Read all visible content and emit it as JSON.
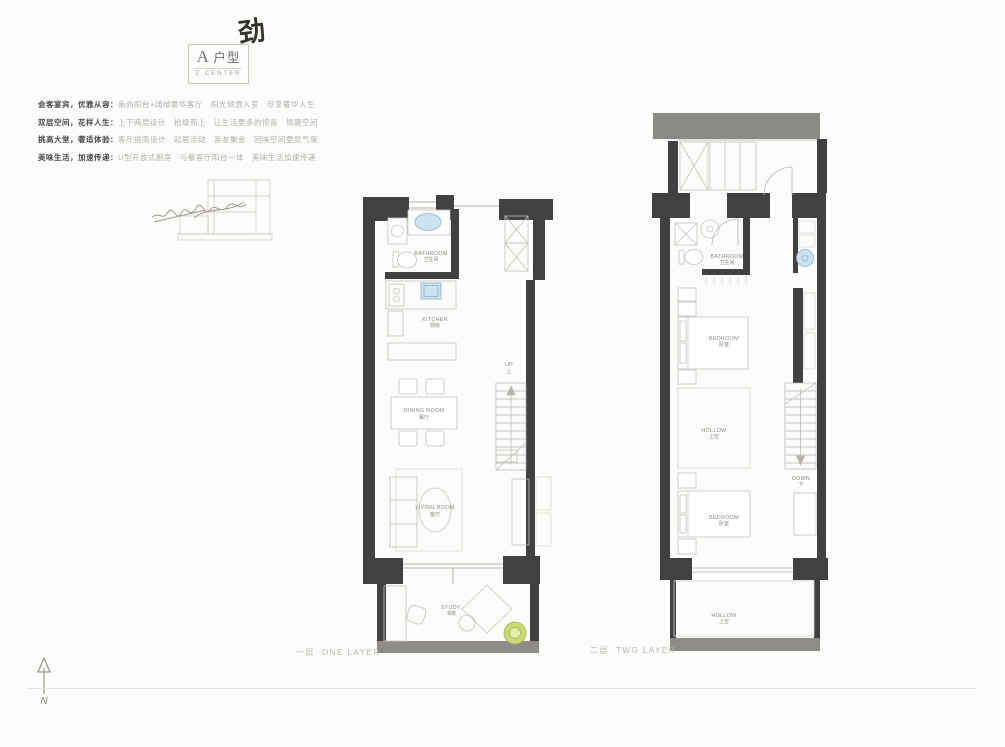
{
  "page": {
    "handwritten_mark": "劲"
  },
  "title_block": {
    "letter": "A",
    "suffix": "户型",
    "subtitle": "Z CENTER"
  },
  "description": {
    "lines": [
      {
        "head": "会客宴宾，优雅从容：",
        "body": "南向阳台+阔绰豪华客厅　阳光倾洒入室　尽享奢华人生"
      },
      {
        "head": "双层空间，花样人生：",
        "body": "上下两层设计　拾级而上　让生活更多的惊喜　情趣空间"
      },
      {
        "head": "挑高大堂，奢适体验：",
        "body": "客厅挑高设计　起居活动　亲友聚会　回味空间更显气度"
      },
      {
        "head": "美味生活，加速传递：",
        "body": "U型开放式厨房　与餐客厅阳台一体　美味生活加速传递"
      }
    ]
  },
  "plan_one": {
    "caption_zh": "一层",
    "caption_en": "ONE LAYER",
    "labels": {
      "bathroom_en": "BATHROOM",
      "bathroom_zh": "卫生间",
      "kitchen_en": "KITCHEN",
      "kitchen_zh": "厨房",
      "dining_en": "DINING ROOM",
      "dining_zh": "餐厅",
      "up_en": "UP",
      "up_zh": "上",
      "living_en": "LIVING ROOM",
      "living_zh": "客厅",
      "study_en": "STUDY",
      "study_zh": "书房"
    }
  },
  "plan_two": {
    "caption_zh": "二层",
    "caption_en": "TWO LAYER",
    "labels": {
      "bathroom_en": "BATHROOM",
      "bathroom_zh": "卫生间",
      "bedroom1_en": "BEDROOM",
      "bedroom1_zh": "卧室",
      "hollow1_en": "HOLLOW",
      "hollow1_zh": "上空",
      "down_en": "DOWN",
      "down_zh": "下",
      "bedroom2_en": "BEDROOM",
      "bedroom2_zh": "卧室",
      "hollow2_en": "HOLLOW",
      "hollow2_zh": "上空"
    }
  },
  "compass": {
    "label": "N"
  },
  "colors": {
    "wall": "#414143",
    "wall_light": "#8f8c88",
    "fixture_blue": "#cde2f1",
    "plant_green": "#c9d873",
    "caption_gray": "#b7b3ad"
  }
}
